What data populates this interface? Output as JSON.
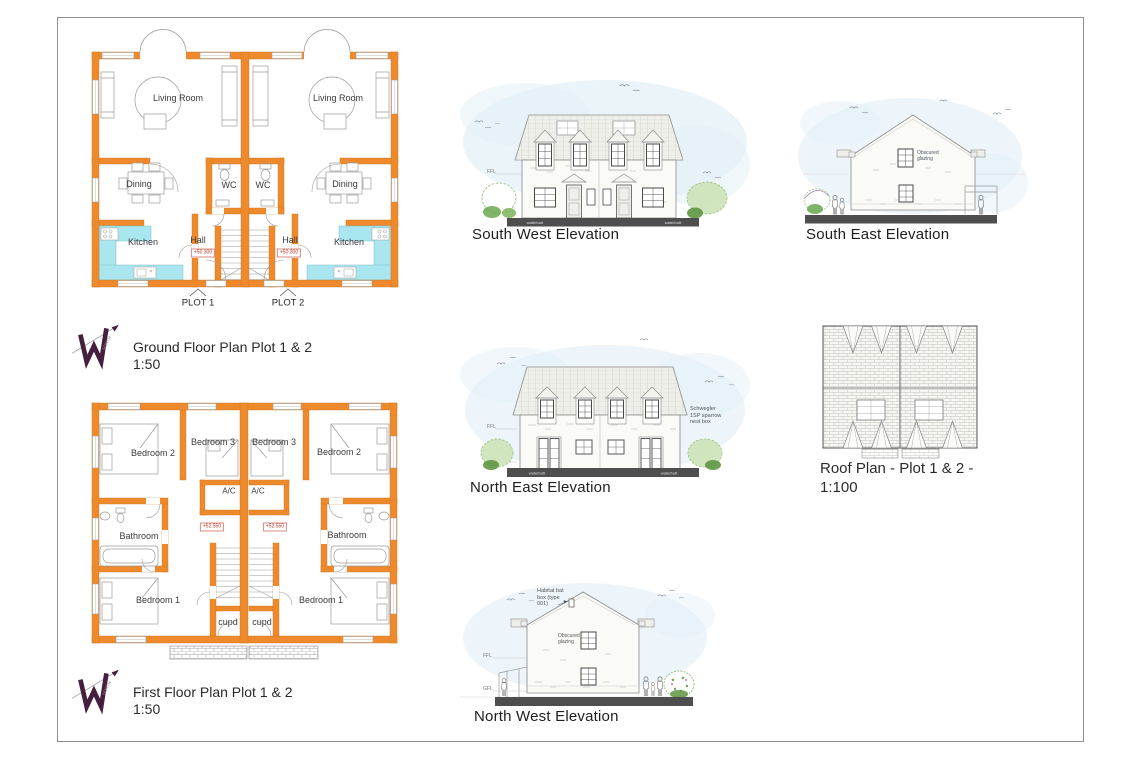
{
  "colors": {
    "wall_orange": "#EF8A2C",
    "kitchen_cyan": "#A9E6EF",
    "sky_wash": "#E3F0F7",
    "ground_bar": "#4E4E4E",
    "logo_purple": "#441F3E",
    "level_red": "#C03A2B"
  },
  "ground_floor": {
    "title": "Ground Floor Plan Plot 1 & 2",
    "scale": "1:50",
    "living_room_left": "Living Room",
    "living_room_right": "Living Room",
    "dining_left": "Dining",
    "dining_right": "Dining",
    "wc_left": "WC",
    "wc_right": "WC",
    "kitchen_left": "Kitchen",
    "kitchen_right": "Kitchen",
    "hall_left": "Hall",
    "hall_right": "Hall",
    "level_left": "+50.300",
    "level_right": "+50.300",
    "plot_1": "PLOT 1",
    "plot_2": "PLOT 2"
  },
  "first_floor": {
    "title": "First Floor Plan Plot 1 & 2",
    "scale": "1:50",
    "bedroom2_left": "Bedroom 2",
    "bedroom3_left": "Bedroom 3",
    "bedroom3_right": "Bedroom 3",
    "bedroom2_right": "Bedroom 2",
    "ac_left": "A/C",
    "ac_right": "A/C",
    "bathroom_left": "Bathroom",
    "bathroom_right": "Bathroom",
    "bedroom1_left": "Bedroom 1",
    "bedroom1_right": "Bedroom 1",
    "cupd_left": "cupd",
    "cupd_right": "cupd",
    "level_left": "+52.550",
    "level_right": "+52.550"
  },
  "elevations": {
    "south_west": {
      "title": "South West Elevation",
      "ffl": "FFL",
      "gfl": "GFL",
      "waterbutt_left": "waterbutt",
      "waterbutt_right": "waterbutt"
    },
    "south_east": {
      "title": "South East Elevation",
      "obscured_glazing": "Obscured\nglazing"
    },
    "north_east": {
      "title": "North East Elevation",
      "ffl": "FFL",
      "gfl": "GFL",
      "waterbutt_left": "waterbutt",
      "waterbutt_right": "waterbutt",
      "nest_box_note": "Schwegler\n1SP sparrow\nnest box"
    },
    "north_west": {
      "title": "North West Elevation",
      "ffl": "FFL",
      "gfl": "GFL",
      "bat_box_note": "Habitat bat\nbox (type\n001)",
      "obscured_glazing": "Obscured\nglazing"
    }
  },
  "roof_plan": {
    "title": "Roof Plan - Plot 1 & 2 -",
    "scale": "1:100"
  },
  "north_arrow_label": "NORTH"
}
